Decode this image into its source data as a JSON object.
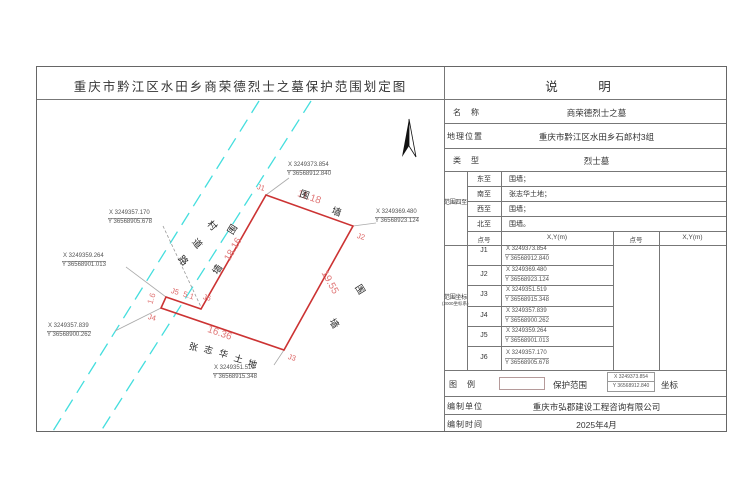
{
  "title": "重庆市黔江区水田乡商荣德烈士之墓保护范围划定图",
  "panel": {
    "header": "说　明",
    "name_label": "名　称",
    "name": "商荣德烈士之墓",
    "location_label": "地理位置",
    "location": "重庆市黔江区水田乡石郎村3组",
    "type_label": "类　型",
    "type": "烈士墓",
    "bounds_label": "范围四至",
    "bounds": [
      {
        "dir": "东至",
        "value": "围墙；"
      },
      {
        "dir": "南至",
        "value": "张志华土地；"
      },
      {
        "dir": "西至",
        "value": "围墙；"
      },
      {
        "dir": "北至",
        "value": "围墙。"
      }
    ],
    "coords_label": "范围坐标",
    "coords_system": "(2000坐标系)",
    "point_header": "点号",
    "xy_header": "X,Y(m)",
    "legend_label": "图　例",
    "legend_range": "保护范围",
    "legend_coord_label": "坐标",
    "author_label": "编制单位",
    "author": "重庆市弘郡建设工程咨询有限公司",
    "date_label": "编制时间",
    "date": "2025年4月"
  },
  "points": [
    {
      "id": "J1",
      "x": "X 3249373.854",
      "y": "Y 36568912.840"
    },
    {
      "id": "J2",
      "x": "X 3249369.480",
      "y": "Y 36568923.124"
    },
    {
      "id": "J3",
      "x": "X 3249351.519",
      "y": "Y 36568915.348"
    },
    {
      "id": "J4",
      "x": "X 3249357.839",
      "y": "Y 36568900.262"
    },
    {
      "id": "J5",
      "x": "X 3249359.264",
      "y": "Y 36568901.013"
    },
    {
      "id": "J6",
      "x": "X 3249357.170",
      "y": "Y 36568905.678"
    }
  ],
  "legend_sample": {
    "x": "X 3249373.854",
    "y": "Y 36568912.840"
  },
  "map": {
    "dims": {
      "top": "11.18",
      "right": "19.55",
      "bottom": "16.36",
      "left": "18.16",
      "notch_short": "1.6",
      "notch_long": "5.1"
    },
    "wall_top": [
      "围",
      "墙"
    ],
    "wall_left": [
      "围",
      "墙"
    ],
    "wall_right": [
      "围",
      "墙"
    ],
    "land": [
      "张",
      "志",
      "华",
      "土",
      "地"
    ],
    "road": [
      "村",
      "道",
      "路"
    ]
  },
  "colors": {
    "boundary": "#cc3333",
    "road": "#44dede"
  }
}
